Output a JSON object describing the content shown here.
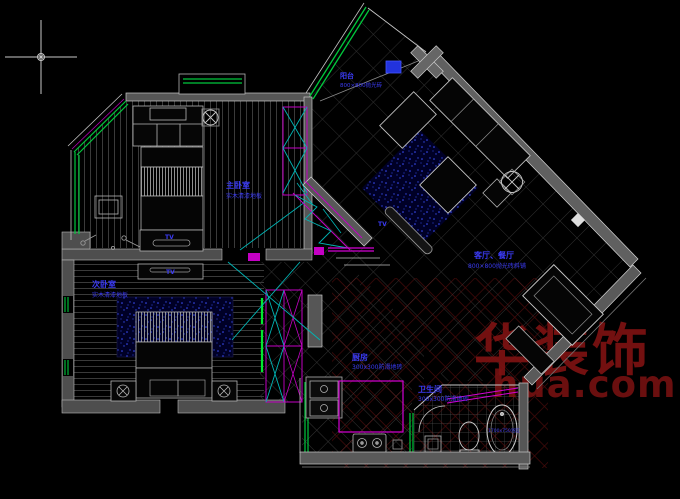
{
  "rooms": {
    "bedroom_a": {
      "name": "主卧室",
      "finish": "实木清漆地板"
    },
    "bedroom_b": {
      "name": "次卧室",
      "finish": "实木清漆地板"
    },
    "living_dining": {
      "name": "客厅、餐厅",
      "finish": "800×800抛光砖斜铺"
    },
    "balcony": {
      "name": "阳台",
      "finish": "800×800抛光砖"
    },
    "kitchen": {
      "name": "厨房",
      "finish": "300x300防滑地砖"
    },
    "bathroom": {
      "name": "卫生间",
      "finish": "300x300防滑地砖"
    }
  },
  "fixtures": {
    "tv_label": "TV",
    "bathtub_label": "1700x750浴缸"
  },
  "watermark": {
    "brand": "华装饰",
    "domain": "hua.com"
  },
  "colors": {
    "label_blue": "#3b3bf5",
    "line_green": "#00c83c",
    "line_cyan": "#00c8c8",
    "line_magenta": "#d400d4",
    "wall_gray": "#565656",
    "watermark_red": "#7d1212"
  }
}
